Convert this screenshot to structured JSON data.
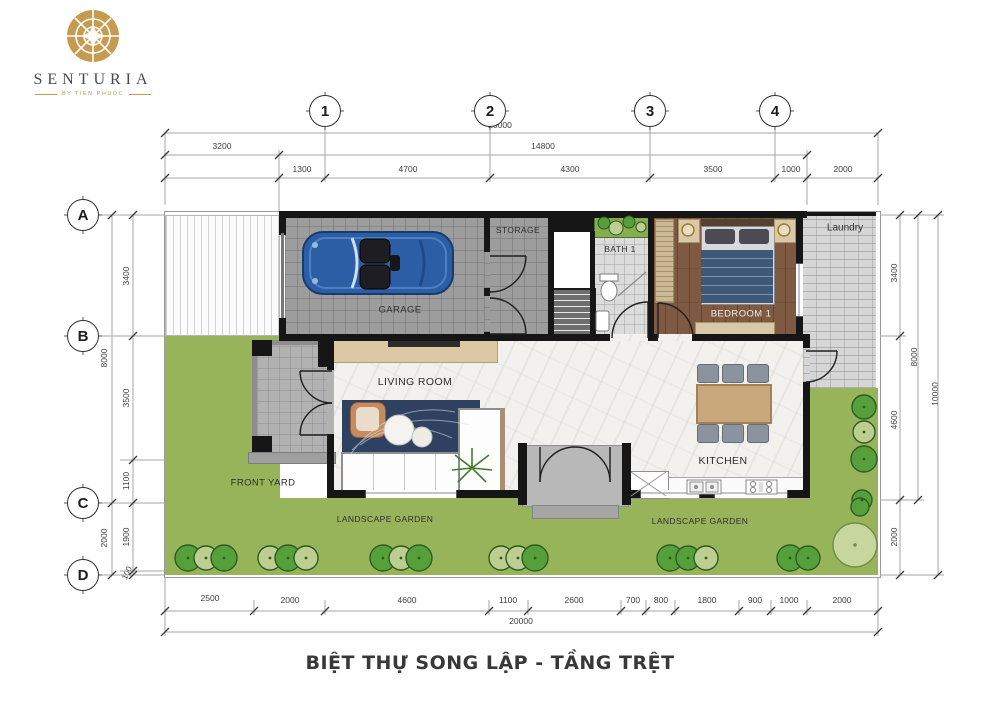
{
  "brand": {
    "name": "SENTURIA",
    "tagline": "BY TIEN PHUOC"
  },
  "title": "BIỆT THỰ SONG LẬP - TẦNG TRỆT",
  "grid": {
    "columns": [
      "1",
      "2",
      "3",
      "4"
    ],
    "rows": [
      "A",
      "B",
      "C",
      "D"
    ]
  },
  "dimensions": {
    "top": {
      "total": "20000",
      "row2": [
        "3200",
        "14800"
      ],
      "row3": [
        "1300",
        "4700",
        "4300",
        "3500",
        "1000",
        "2000"
      ]
    },
    "bottom": {
      "segments": [
        "2500",
        "2000",
        "4600",
        "1100",
        "2600",
        "700",
        "800",
        "1800",
        "900",
        "1000",
        "2000"
      ],
      "total": "20000"
    },
    "left": {
      "outer": [
        "8000",
        "2000"
      ],
      "inner": [
        "3400",
        "3500",
        "1100",
        "1900",
        "100"
      ]
    },
    "right": {
      "inner": [
        "3400",
        "4600",
        "2000"
      ],
      "middle": "8000",
      "outer": "10000"
    }
  },
  "rooms": {
    "garage": "GARAGE",
    "storage": "STORAGE",
    "bath1": "BATH 1",
    "bedroom1": "BEDROOM 1",
    "laundry": "Laundry",
    "living": "LIVING ROOM",
    "kitchen": "KITCHEN",
    "front_yard": "FRONT YARD",
    "landscape_garden": "LANDSCAPE GARDEN"
  },
  "colors": {
    "brand_gold": "#c59a4e",
    "garden_green": "#97b45a",
    "tree_dark": "#55a03b",
    "tree_light": "#bccf90",
    "wall_black": "#161616",
    "car_blue": "#2c5ea6",
    "rug_navy": "#2e4160",
    "wood_brown": "#7e5a43",
    "marble_white": "#f2f1ee",
    "floor_gray": "#9d9d9d",
    "hatch_gray": "#d6d6d6",
    "title_color": "#383838"
  }
}
